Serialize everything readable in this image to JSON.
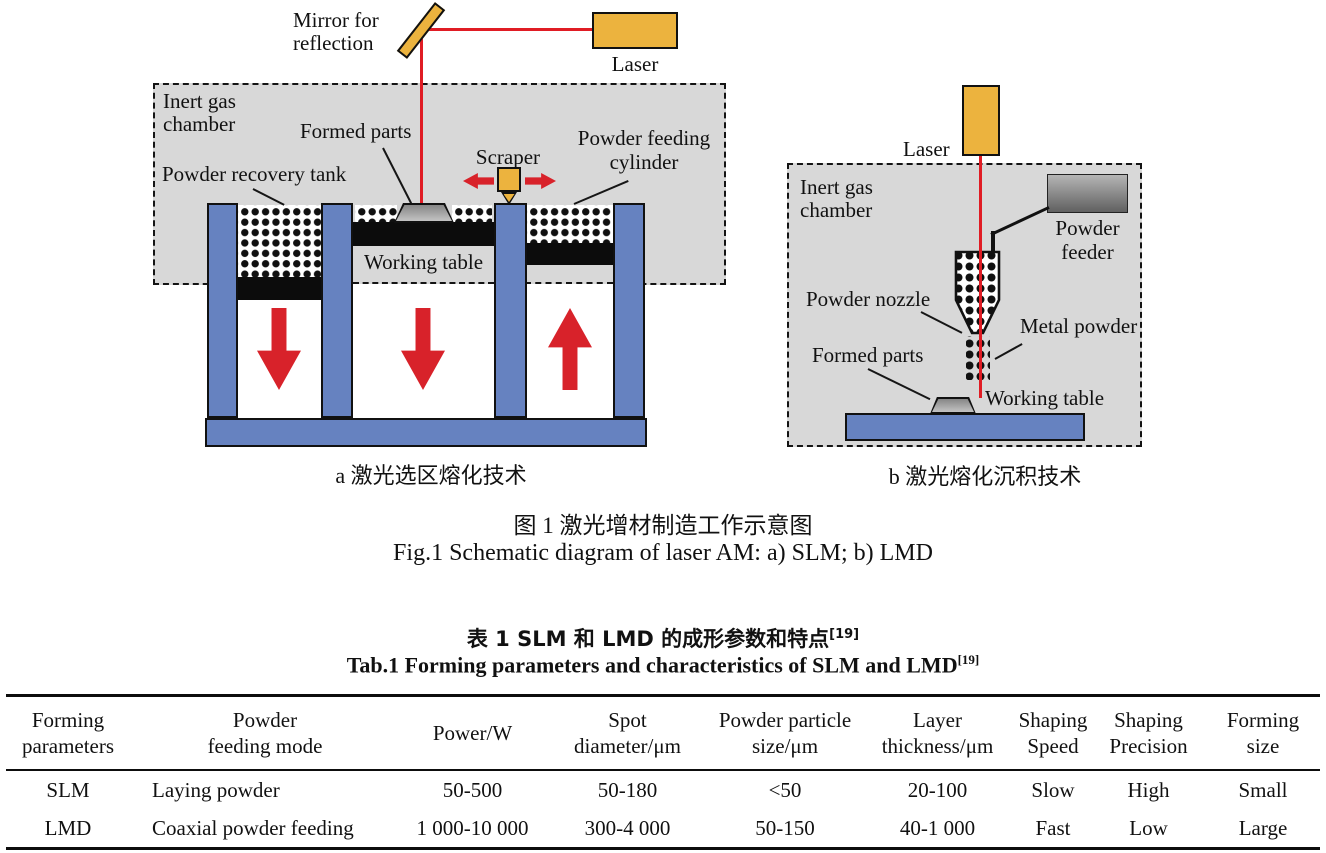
{
  "figure": {
    "a": {
      "mirror_line1": "Mirror for",
      "mirror_line2": "reflection",
      "laser": "Laser",
      "chamber_line1": "Inert gas",
      "chamber_line2": "chamber",
      "formed_parts": "Formed parts",
      "recovery": "Powder recovery tank",
      "scraper": "Scraper",
      "cylinder_line1": "Powder feeding",
      "cylinder_line2": "cylinder",
      "working_table": "Working table",
      "caption": "a  激光选区熔化技术"
    },
    "b": {
      "laser": "Laser",
      "chamber_line1": "Inert gas",
      "chamber_line2": "chamber",
      "feeder_line1": "Powder",
      "feeder_line2": "feeder",
      "nozzle": "Powder nozzle",
      "metal": "Metal powder",
      "formed_parts": "Formed parts",
      "working_table": "Working table",
      "caption": "b  激光熔化沉积技术"
    },
    "caption_zh": "图 1    激光增材制造工作示意图",
    "caption_en": "Fig.1 Schematic diagram of laser AM: a) SLM; b) LMD"
  },
  "table": {
    "title_zh": "表 1    SLM 和 LMD 的成形参数和特点",
    "title_sup": "[19]",
    "title_en": "Tab.1 Forming parameters and characteristics of SLM and LMD",
    "headers": [
      {
        "line1": "Forming",
        "line2": "parameters"
      },
      {
        "line1": "Powder",
        "line2": "feeding mode"
      },
      {
        "line1": "Power/W",
        "line2": ""
      },
      {
        "line1": "Spot",
        "line2": "diameter/μm"
      },
      {
        "line1": "Powder particle",
        "line2": "size/μm"
      },
      {
        "line1": "Layer",
        "line2": "thickness/μm"
      },
      {
        "line1": "Shaping",
        "line2": "Speed"
      },
      {
        "line1": "Shaping",
        "line2": "Precision"
      },
      {
        "line1": "Forming",
        "line2": "size"
      }
    ],
    "rows": [
      {
        "cells": [
          "SLM",
          "Laying powder",
          "50-500",
          "50-180",
          "<50",
          "20-100",
          "Slow",
          "High",
          "Small"
        ]
      },
      {
        "cells": [
          "LMD",
          "Coaxial powder feeding",
          "1 000-10 000",
          "300-4 000",
          "50-150",
          "40-1 000",
          "Fast",
          "Low",
          "Large"
        ]
      }
    ]
  },
  "colors": {
    "laser_yellow": "#ecb33e",
    "piston_blue": "#6682c0",
    "chamber_gray": "#d8d8d8",
    "beam_red": "#e01c24",
    "arrow_red": "#d8222a",
    "part_gray": "#9a9a9a",
    "feeder_gray": "#8a8a8a"
  }
}
